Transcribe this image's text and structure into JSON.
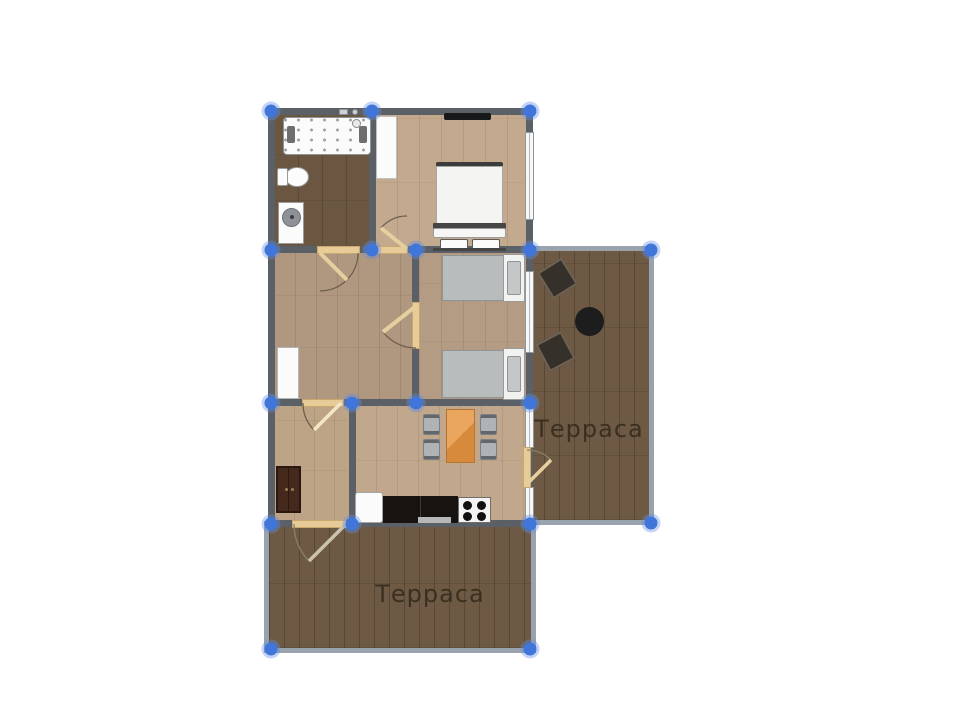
{
  "app": {
    "type": "floor-plan-editor",
    "view": "2d-plan"
  },
  "labels": {
    "terrace_right": "Терраса",
    "terrace_bottom": "Терраса"
  },
  "colors": {
    "background": "#ffffff",
    "wall": "#5b6066",
    "terrace_border": "#9aa2ad",
    "selection_handle": "#4076d9",
    "door_leaf": "#e8cc98",
    "bathroom_floor": "#6b5741",
    "bedroom1_floor": "#c3a98e",
    "hall_floor": "#b0977f",
    "bedroom2_floor": "#b49b83",
    "entry_floor": "#bda486",
    "kitchen_floor": "#c1a88c",
    "terrace_floor": "#6e5a44",
    "dining_table": "#e2984e",
    "label_text": "#3b2f20"
  },
  "icons": {
    "furniture": [
      "jacuzzi-bathtub",
      "toilet",
      "sink-vanity",
      "double-bed",
      "wall-tv",
      "closet-white",
      "single-bed-1",
      "single-bed-2",
      "wardrobe-white",
      "wardrobe-dark",
      "dining-table",
      "dining-chair",
      "fridge",
      "kitchen-counter",
      "stove-4-burners",
      "terrace-chair",
      "round-table"
    ],
    "selection_handles_count": 18
  }
}
